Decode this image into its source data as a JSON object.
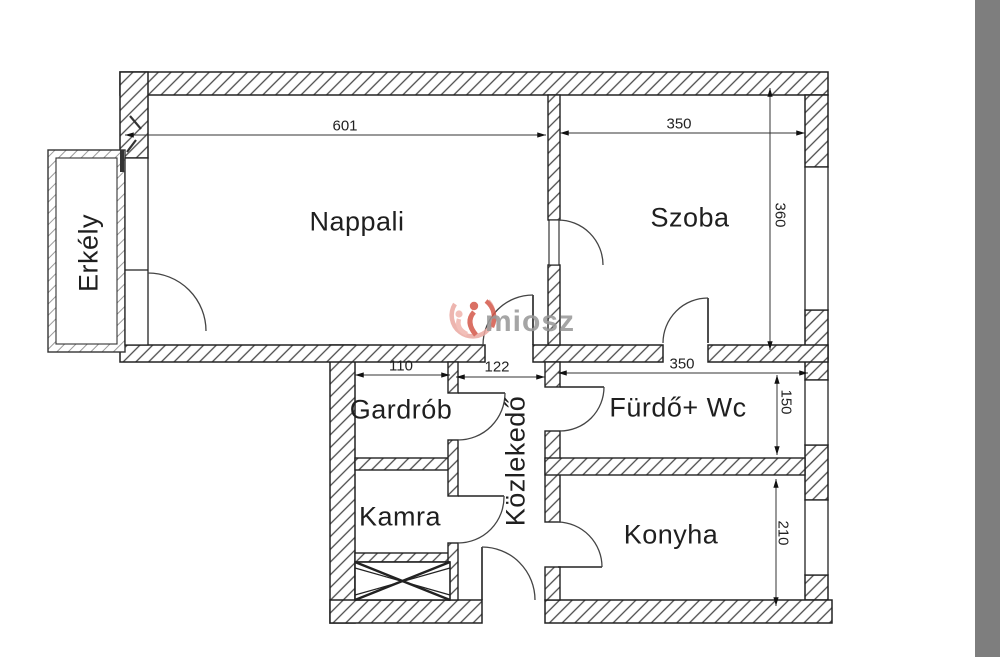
{
  "floorplan": {
    "rooms": [
      {
        "id": "nappali",
        "label": "Nappali"
      },
      {
        "id": "szoba",
        "label": "Szoba"
      },
      {
        "id": "erkely",
        "label": "Erkély"
      },
      {
        "id": "gardrob",
        "label": "Gardrób"
      },
      {
        "id": "kamra",
        "label": "Kamra"
      },
      {
        "id": "kozlekedo",
        "label": "Közlekedő"
      },
      {
        "id": "furdo_wc",
        "label": "Fürdő+ Wc"
      },
      {
        "id": "konyha",
        "label": "Konyha"
      }
    ],
    "dimensions_cm": {
      "nappali_width": "601",
      "szoba_width": "350",
      "szoba_depth": "360",
      "gardrob_width": "110",
      "kozlekedo_width": "122",
      "furdo_width": "350",
      "furdo_depth": "150",
      "konyha_depth": "210"
    },
    "watermark": {
      "text": "miosz"
    },
    "colors": {
      "line": "#222222",
      "wall_hatch": "#4a4a4a",
      "background": "#ffffff",
      "edge_bar": "#7e7e7e",
      "watermark_text": "#989898",
      "watermark_red": "#d4584a",
      "watermark_pink": "#eba9a2"
    }
  }
}
